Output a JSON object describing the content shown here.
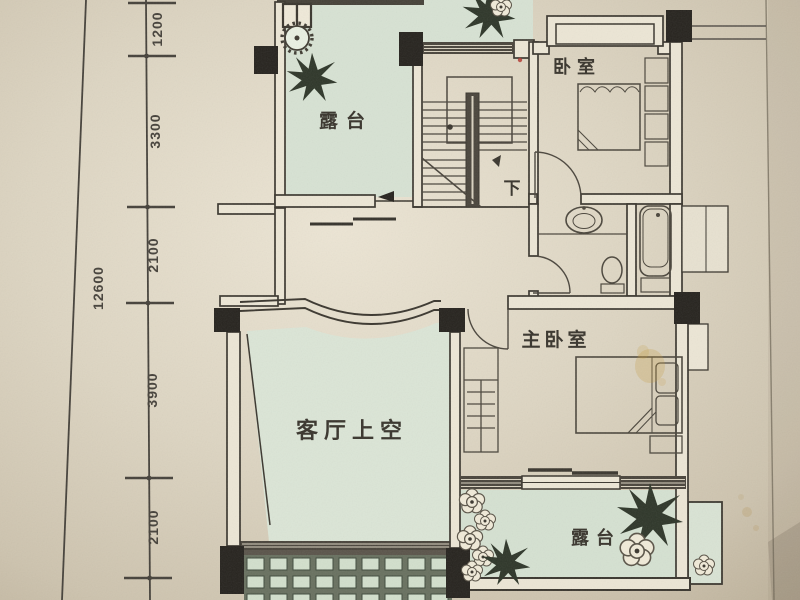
{
  "document": {
    "kind_note": "photographed architectural floor plan (upper storey)",
    "dimensions": {
      "total_left": "12600",
      "segments": [
        "1200",
        "3300",
        "2100",
        "3900",
        "2100"
      ]
    },
    "rooms": {
      "terrace_top": {
        "label": "露台"
      },
      "bedroom": {
        "label": "卧室"
      },
      "stair": {
        "down_label": "下"
      },
      "master_bedroom": {
        "label": "主卧室"
      },
      "living_void": {
        "label": "客厅上空"
      },
      "terrace_bottom": {
        "label": "露台"
      }
    },
    "colors": {
      "paper": "#d8cfbc",
      "plan_green": "#d7e2d3",
      "wall": "#3a362e",
      "column": "#26231e",
      "grid_cell": "#d2dfcc",
      "grid_grout": "#68705f",
      "stain": "#c59a3e",
      "red_mark": "#b33a31",
      "text": "#38342c"
    }
  }
}
